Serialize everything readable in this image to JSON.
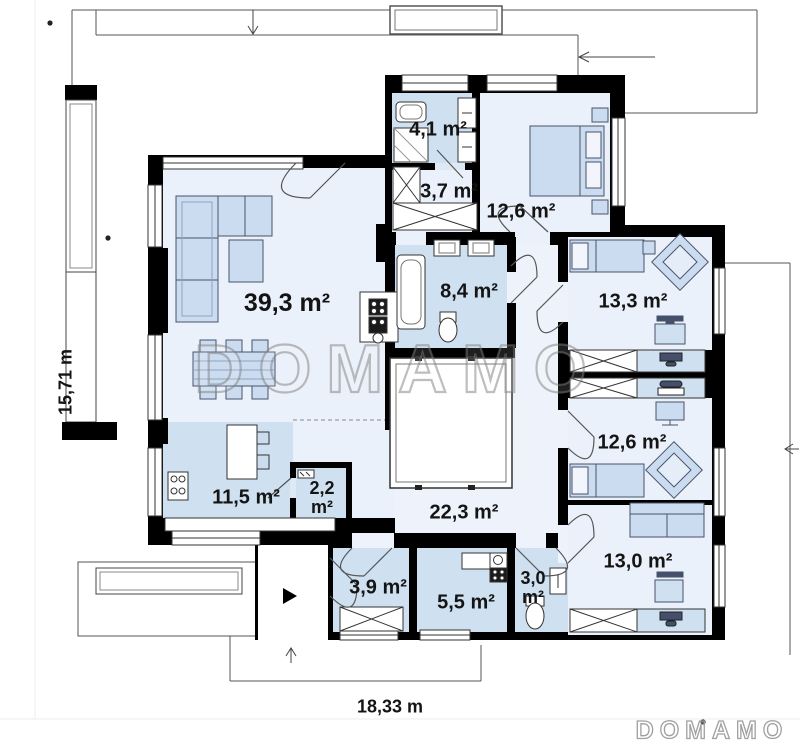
{
  "plan": {
    "watermark_text": "DOMAMO",
    "logo_text": "DOMAMO",
    "dimensions": {
      "height_label": "15,71 m",
      "width_label": "18,33 m"
    },
    "rooms": [
      {
        "name": "living-room",
        "area_label": "39,3 m²"
      },
      {
        "name": "bathroom-small",
        "area_label": "4,1 m²"
      },
      {
        "name": "wardrobe-hall",
        "area_label": "3,7 m²"
      },
      {
        "name": "bedroom-top",
        "area_label": "12,6 m²"
      },
      {
        "name": "bathroom-main",
        "area_label": "8,4 m²"
      },
      {
        "name": "bedroom-right-1",
        "area_label": "13,3 m²"
      },
      {
        "name": "bedroom-right-2",
        "area_label": "12,6 m²"
      },
      {
        "name": "kitchen",
        "area_label": "11,5 m²"
      },
      {
        "name": "pantry",
        "area_value": "2,2",
        "area_unit": "m²"
      },
      {
        "name": "hall",
        "area_label": "22,3 m²"
      },
      {
        "name": "bedroom-right-3",
        "area_label": "13,0 m²"
      },
      {
        "name": "entry-hall",
        "area_label": "3,9 m²"
      },
      {
        "name": "utility-room",
        "area_label": "5,5 m²"
      },
      {
        "name": "wc",
        "area_value": "3,0",
        "area_unit": "m²"
      }
    ],
    "colors": {
      "wall": "#000000",
      "floor_light": "#ebf1fa",
      "floor_blue": "#cfe0f1",
      "furniture": "#ccdcf0",
      "label_text": "#141414"
    }
  }
}
